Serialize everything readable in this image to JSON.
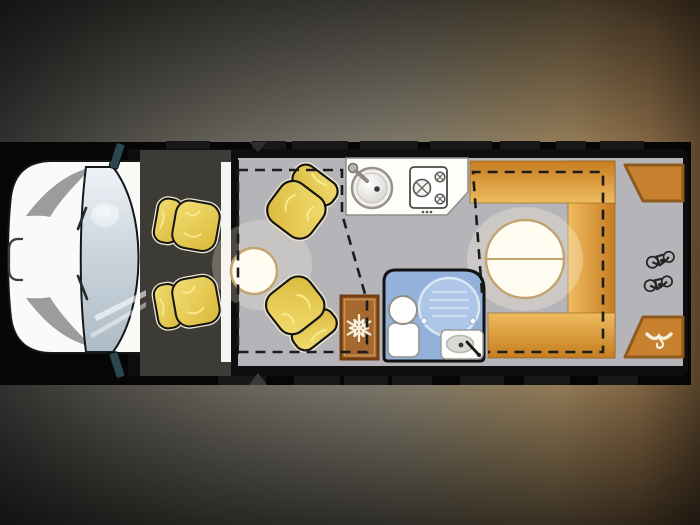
{
  "scene": {
    "title": "Motorhome floor plan - top view",
    "strip_background": "#060606"
  },
  "colors": {
    "body_black": "#0e0e0e",
    "cab_white": "#fafaf8",
    "cab_interior": "#3c3b35",
    "windshield_light": "#eef3f7",
    "windshield_dark": "#aebcc7",
    "floor_gray": "#b5b4b8",
    "garage_gray": "#b2b1b5",
    "seat_yellow": "#e9cd55",
    "seat_outline": "#151515",
    "table_white": "#fffdf2",
    "table_border": "#c2a470",
    "counter_white": "#fdfdfa",
    "dinette_orange_light": "#eebc5e",
    "dinette_orange_dark": "#c67c20",
    "wardrobe_brown": "#c8822f",
    "wardrobe_border": "#8f5a1d",
    "fridge_brown": "#a5682e",
    "fridge_border": "#6f3d12",
    "bathroom_blue": "#93b1da",
    "shower_blue": "#aec6e8",
    "icon_cream": "#f6efdb",
    "dash_black": "#1c1c1c",
    "mirror_teal": "#2b4650"
  },
  "cab": {
    "fixtures": [
      {
        "name": "driver-seat"
      },
      {
        "name": "passenger-seat"
      },
      {
        "name": "windshield"
      },
      {
        "name": "mirror-top"
      },
      {
        "name": "mirror-bottom"
      },
      {
        "name": "front-grille-badge"
      }
    ]
  },
  "lounge": {
    "fixtures": [
      {
        "name": "swivel-seat-front"
      },
      {
        "name": "swivel-seat-rear"
      },
      {
        "name": "round-side-table"
      },
      {
        "name": "drop-down-bed-outline",
        "style": "dashed"
      }
    ]
  },
  "kitchen": {
    "fixtures": [
      {
        "name": "sink"
      },
      {
        "name": "faucet"
      },
      {
        "name": "hob",
        "burners": 3
      },
      {
        "name": "fridge",
        "icon": "snowflake-icon"
      }
    ]
  },
  "bathroom": {
    "fixtures": [
      {
        "name": "shower-tray"
      },
      {
        "name": "toilet"
      },
      {
        "name": "washbasin"
      },
      {
        "name": "hand-shower"
      }
    ]
  },
  "dinette": {
    "fixtures": [
      {
        "name": "bench-top"
      },
      {
        "name": "bench-rear"
      },
      {
        "name": "bench-bottom"
      },
      {
        "name": "round-dining-table",
        "split_line": true
      },
      {
        "name": "drop-down-bed-outline",
        "style": "dashed"
      }
    ]
  },
  "rear": {
    "fixtures": [
      {
        "name": "garage"
      },
      {
        "name": "bicycle-icon",
        "count": 2
      },
      {
        "name": "wardrobe-top"
      },
      {
        "name": "wardrobe-bottom",
        "icon": "coat-hanger-icon"
      }
    ]
  }
}
